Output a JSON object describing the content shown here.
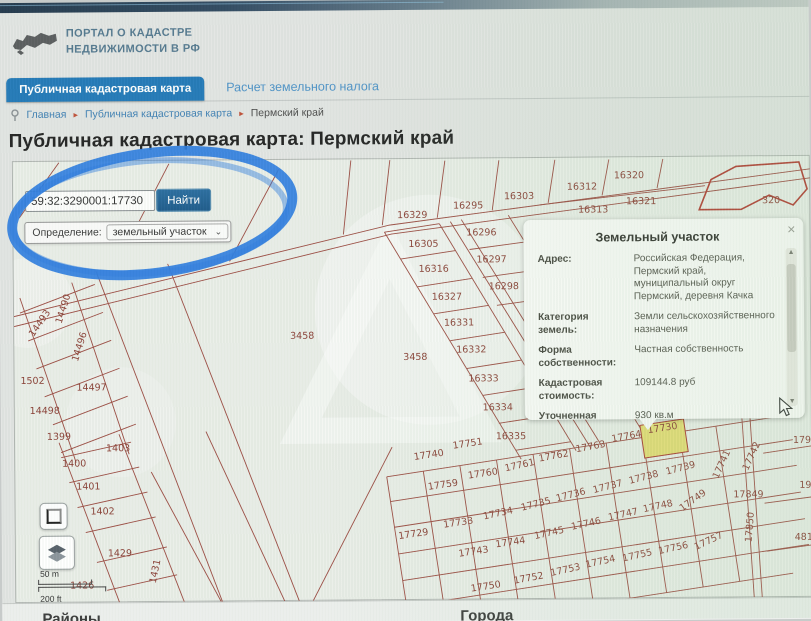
{
  "header": {
    "logo_line1": "ПОРТАЛ О КАДАСТРЕ",
    "logo_line2": "НЕДВИЖИМОСТИ В РФ"
  },
  "tabs": [
    {
      "label": "Публичная кадастровая карта",
      "active": true
    },
    {
      "label": "Расчет земельного налога",
      "active": false
    }
  ],
  "breadcrumb": {
    "items": [
      "Главная",
      "Публичная кадастровая карта",
      "Пермский край"
    ],
    "separator": "▸"
  },
  "page_title": "Публичная кадастровая карта: Пермский край",
  "search": {
    "query": "59:32:3290001:17730",
    "find_button": "Найти",
    "definition_label": "Определение:",
    "definition_value": "земельный участок",
    "dropdown_chevron": "⌄"
  },
  "info_panel": {
    "title": "Земельный участок",
    "close_icon": "×",
    "scroll_up_icon": "▲",
    "scroll_down_icon": "▼",
    "rows": [
      {
        "label": "Адрес:",
        "value": "Российская Федерация, Пермский край, муниципальный округ Пермский, деревня Качка"
      },
      {
        "label": "Категория земель:",
        "value": "Земли сельскохозяйственного назначения"
      },
      {
        "label": "Форма собственности:",
        "value": "Частная собственность"
      },
      {
        "label": "Кадастровая стоимость:",
        "value": "109144.8 руб"
      },
      {
        "label": "Уточненная площадь:",
        "value": "930 кв.м"
      },
      {
        "label": "Разрешенное использование:",
        "value": "Для садоводства"
      }
    ]
  },
  "map": {
    "selected_parcel": "17730",
    "scale_metric": "50 m",
    "scale_imperial": "200 ft",
    "parcel_labels": [
      {
        "t": "16329",
        "x": 413,
        "y": 218
      },
      {
        "t": "16295",
        "x": 469,
        "y": 209
      },
      {
        "t": "16303",
        "x": 520,
        "y": 200
      },
      {
        "t": "16312",
        "x": 583,
        "y": 191
      },
      {
        "t": "16320",
        "x": 630,
        "y": 180
      },
      {
        "t": "16321",
        "x": 642,
        "y": 206
      },
      {
        "t": "16313",
        "x": 594,
        "y": 214
      },
      {
        "t": "320",
        "x": 772,
        "y": 206
      },
      {
        "t": "16305",
        "x": 424,
        "y": 247
      },
      {
        "t": "16296",
        "x": 482,
        "y": 236
      },
      {
        "t": "16297",
        "x": 492,
        "y": 263
      },
      {
        "t": "16316",
        "x": 434,
        "y": 272
      },
      {
        "t": "16327",
        "x": 447,
        "y": 300
      },
      {
        "t": "16298",
        "x": 504,
        "y": 290
      },
      {
        "t": "16331",
        "x": 459,
        "y": 326
      },
      {
        "t": "16332",
        "x": 471,
        "y": 353
      },
      {
        "t": "16333",
        "x": 483,
        "y": 382
      },
      {
        "t": "16334",
        "x": 497,
        "y": 411
      },
      {
        "t": "16335",
        "x": 510,
        "y": 440
      },
      {
        "t": "3458",
        "x": 302,
        "y": 338
      },
      {
        "t": "3458",
        "x": 415,
        "y": 360
      },
      {
        "t": "14493",
        "x": 42,
        "y": 322,
        "r": -55
      },
      {
        "t": "14490",
        "x": 66,
        "y": 307,
        "r": -72
      },
      {
        "t": "14496",
        "x": 82,
        "y": 345,
        "r": -72
      },
      {
        "t": "1502",
        "x": 32,
        "y": 381
      },
      {
        "t": "14497",
        "x": 91,
        "y": 388
      },
      {
        "t": "14498",
        "x": 44,
        "y": 411
      },
      {
        "t": "1399",
        "x": 58,
        "y": 437
      },
      {
        "t": "1403",
        "x": 117,
        "y": 449
      },
      {
        "t": "1400",
        "x": 73,
        "y": 464
      },
      {
        "t": "1401",
        "x": 87,
        "y": 487
      },
      {
        "t": "1402",
        "x": 101,
        "y": 512
      },
      {
        "t": "1429",
        "x": 118,
        "y": 554
      },
      {
        "t": "1431",
        "x": 156,
        "y": 570,
        "r": -78
      },
      {
        "t": "1426",
        "x": 80,
        "y": 586
      },
      {
        "t": "17729",
        "x": 412,
        "y": 537,
        "r": -8
      },
      {
        "t": "17740",
        "x": 428,
        "y": 458,
        "r": -8
      },
      {
        "t": "17751",
        "x": 467,
        "y": 447,
        "r": -8
      },
      {
        "t": "17762",
        "x": 553,
        "y": 460,
        "r": -10
      },
      {
        "t": "17763",
        "x": 590,
        "y": 451,
        "r": -10
      },
      {
        "t": "17764",
        "x": 626,
        "y": 441,
        "r": -10
      },
      {
        "t": "17730",
        "x": 662,
        "y": 433,
        "r": -8
      },
      {
        "t": "17759",
        "x": 442,
        "y": 488,
        "r": -8
      },
      {
        "t": "17760",
        "x": 482,
        "y": 477,
        "r": -8
      },
      {
        "t": "17761",
        "x": 519,
        "y": 469,
        "r": -12
      },
      {
        "t": "17733",
        "x": 457,
        "y": 526,
        "r": -8
      },
      {
        "t": "17734",
        "x": 497,
        "y": 517,
        "r": -12
      },
      {
        "t": "17735",
        "x": 535,
        "y": 508,
        "r": -14
      },
      {
        "t": "17736",
        "x": 570,
        "y": 499,
        "r": -14
      },
      {
        "t": "17737",
        "x": 607,
        "y": 491,
        "r": -14
      },
      {
        "t": "17738",
        "x": 643,
        "y": 482,
        "r": -14
      },
      {
        "t": "17739",
        "x": 680,
        "y": 473,
        "r": -14
      },
      {
        "t": "17749",
        "x": 693,
        "y": 505,
        "r": -35
      },
      {
        "t": "17849",
        "x": 747,
        "y": 500
      },
      {
        "t": "17741",
        "x": 723,
        "y": 468,
        "r": -65
      },
      {
        "t": "17742",
        "x": 753,
        "y": 460,
        "r": -65
      },
      {
        "t": "17850",
        "x": 751,
        "y": 530,
        "r": -85
      },
      {
        "t": "17743",
        "x": 472,
        "y": 555,
        "r": -8
      },
      {
        "t": "17744",
        "x": 509,
        "y": 546,
        "r": -8
      },
      {
        "t": "17745",
        "x": 548,
        "y": 537,
        "r": -12
      },
      {
        "t": "17746",
        "x": 585,
        "y": 528,
        "r": -12
      },
      {
        "t": "17747",
        "x": 622,
        "y": 519,
        "r": -12
      },
      {
        "t": "17748",
        "x": 657,
        "y": 511,
        "r": -12
      },
      {
        "t": "17757",
        "x": 708,
        "y": 546,
        "r": -25
      },
      {
        "t": "17756",
        "x": 672,
        "y": 553,
        "r": -12
      },
      {
        "t": "17755",
        "x": 636,
        "y": 560,
        "r": -12
      },
      {
        "t": "17754",
        "x": 599,
        "y": 566,
        "r": -12
      },
      {
        "t": "17753",
        "x": 564,
        "y": 574,
        "r": -12
      },
      {
        "t": "17752",
        "x": 527,
        "y": 582,
        "r": -10
      },
      {
        "t": "17750",
        "x": 484,
        "y": 590,
        "r": -8
      },
      {
        "t": "179",
        "x": 801,
        "y": 446
      },
      {
        "t": "19",
        "x": 804,
        "y": 491
      },
      {
        "t": "481",
        "x": 802,
        "y": 543
      }
    ]
  },
  "footer": {
    "left_heading": "Районы",
    "right_heading": "Города"
  },
  "colors": {
    "tab_active": "#2279b8",
    "find_button": "#1d5a8b",
    "parcel_line": "#9c4b42",
    "selected_parcel_fill": "#e5dd74",
    "annotation_blue": "#2e7de0"
  }
}
